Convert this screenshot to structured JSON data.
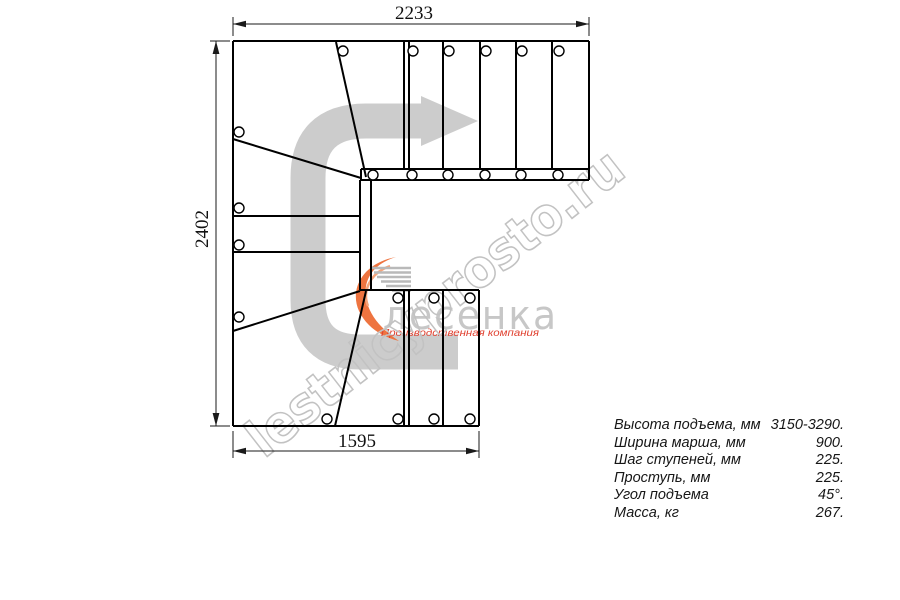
{
  "dimensions": {
    "top_label": "2233",
    "left_label": "2402",
    "bottom_label": "1595"
  },
  "specs": [
    {
      "label": "Высота подъема, мм",
      "value": "3150-3290."
    },
    {
      "label": "Ширина марша, мм",
      "value": "900."
    },
    {
      "label": "Шаг ступеней, мм",
      "value": "225."
    },
    {
      "label": "Проступь, мм",
      "value": "225."
    },
    {
      "label": "Угол подъема",
      "value": "45°."
    },
    {
      "label": "Масса, кг",
      "value": "267."
    }
  ],
  "branding": {
    "watermark": "lestnicyprosto.ru",
    "logo_text": "лесенка",
    "logo_tagline": "Производственная компания"
  },
  "colors": {
    "line": "#000000",
    "dim": "#1a1a1a",
    "flow_arrow": "#cccccc",
    "watermark": "#c2c2c2",
    "logo_gray": "#c7c7c7",
    "logo_lines": "#b9b9b9",
    "logo_orange": "#ee7440",
    "logo_orange_light": "#f5a57c",
    "tagline_red": "#e0402f"
  },
  "plan": {
    "segments": [
      [
        233,
        41,
        589,
        41
      ],
      [
        589,
        41,
        589,
        180
      ],
      [
        589,
        180,
        360,
        180
      ],
      [
        233,
        41,
        233,
        426
      ],
      [
        233,
        426,
        479,
        426
      ],
      [
        479,
        426,
        479,
        290
      ],
      [
        479,
        290,
        360,
        290
      ],
      [
        361,
        169,
        589,
        169
      ],
      [
        361,
        169,
        361,
        181
      ],
      [
        360,
        180,
        360,
        290
      ],
      [
        371,
        180,
        371,
        290
      ],
      [
        404,
        41,
        404,
        169
      ],
      [
        409,
        41,
        409,
        169
      ],
      [
        443,
        41,
        443,
        169
      ],
      [
        480,
        41,
        480,
        169
      ],
      [
        516,
        41,
        516,
        169
      ],
      [
        552,
        41,
        552,
        169
      ],
      [
        233,
        216,
        360,
        216
      ],
      [
        233,
        252,
        360,
        252
      ],
      [
        404,
        290,
        404,
        426
      ],
      [
        409,
        290,
        409,
        426
      ],
      [
        443,
        290,
        443,
        426
      ],
      [
        336,
        42,
        366,
        177
      ],
      [
        233,
        139,
        361,
        178
      ],
      [
        233,
        331,
        360,
        291
      ],
      [
        366,
        291,
        335,
        426
      ]
    ],
    "circles": [
      [
        343,
        51
      ],
      [
        413,
        51
      ],
      [
        449,
        51
      ],
      [
        486,
        51
      ],
      [
        522,
        51
      ],
      [
        559,
        51
      ],
      [
        373,
        175
      ],
      [
        412,
        175
      ],
      [
        448,
        175
      ],
      [
        485,
        175
      ],
      [
        521,
        175
      ],
      [
        558,
        175
      ],
      [
        239,
        132
      ],
      [
        239,
        208
      ],
      [
        239,
        245
      ],
      [
        239,
        317
      ],
      [
        398,
        298
      ],
      [
        434,
        298
      ],
      [
        470,
        298
      ],
      [
        327,
        419
      ],
      [
        398,
        419
      ],
      [
        434,
        419
      ],
      [
        470,
        419
      ]
    ],
    "circle_radius": 5,
    "dim_lines": [
      [
        233,
        36,
        233,
        17
      ],
      [
        589,
        36,
        589,
        17
      ],
      [
        233,
        24,
        589,
        24
      ],
      [
        230,
        41,
        210,
        41
      ],
      [
        230,
        426,
        210,
        426
      ],
      [
        216,
        41,
        216,
        426
      ],
      [
        233,
        431,
        233,
        458
      ],
      [
        479,
        431,
        479,
        458
      ],
      [
        233,
        451,
        479,
        451
      ]
    ],
    "dim_arrowheads": [
      "233,24 246,20.8 246,27.2",
      "589,24 576,20.8 576,27.2",
      "216,41 212.6,54 219.4,54",
      "216,426 212.6,413 219.4,413",
      "233,451 246,447.8 246,454.2",
      "479,451 466,447.8 466,454.2"
    ],
    "flow_arrow": {
      "path": "M 458 352 L 360 352 Q 308 352 308 300 L 308 178 Q 308 121 366 121 L 421 121",
      "width": 35,
      "head": "421,96 478,121 421,146"
    },
    "logo_lines": [
      [
        372,
        268,
        411,
        268
      ],
      [
        374,
        272.5,
        411,
        272.5
      ],
      [
        377,
        277,
        411,
        277
      ],
      [
        381,
        281.5,
        411,
        281.5
      ],
      [
        386,
        286,
        411,
        286
      ],
      [
        392,
        290.5,
        411,
        290.5
      ]
    ],
    "logo_paths": [
      {
        "d": "M 396 257 C 363 263 349 289 359 311 C 367 328 383 337 399 341 C 381 329 369 315 366 298 C 363 277 376 263 396 257 Z",
        "type": "fill"
      },
      {
        "d": "M 390 266 C 370 273 362 291 368 306",
        "type": "stroke"
      }
    ]
  }
}
